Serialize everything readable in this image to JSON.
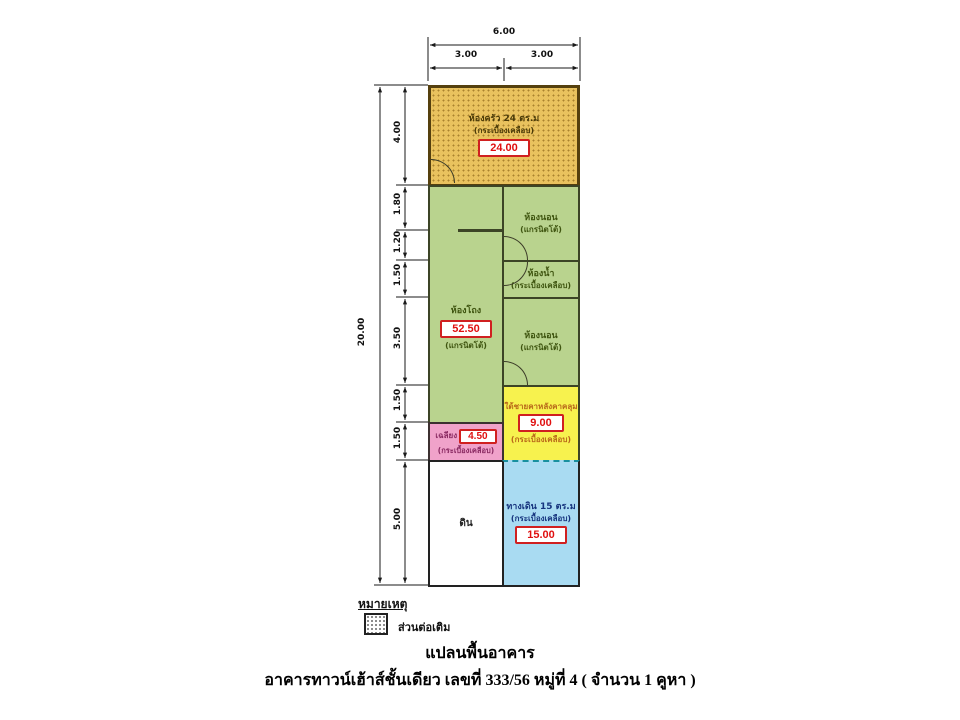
{
  "dims": {
    "top_total": "6.00",
    "top_segments": [
      "3.00",
      "3.00"
    ],
    "left_total": "20.00",
    "left_segments": [
      "4.00",
      "1.80",
      "1.20",
      "1.50",
      "3.50",
      "1.50",
      "1.50",
      "5.00"
    ]
  },
  "rooms": {
    "kitchen": {
      "name": "ห้องครัว 24 ตร.ม",
      "material": "(กระเบื้องเคลือบ)",
      "area": "24.00"
    },
    "hall": {
      "name": "ห้องโถง",
      "area": "52.50",
      "material": "(แกรนิตโต้)"
    },
    "bedroom_top": {
      "name": "ห้องนอน",
      "material": "(แกรนิตโต้)"
    },
    "bathroom": {
      "name": "ห้องน้ำ",
      "material": "(กระเบื้องเคลือบ)"
    },
    "bedroom_bottom": {
      "name": "ห้องนอน",
      "material": "(แกรนิตโต้)"
    },
    "covered_area": {
      "name": "ใต้ชายคาหลังคาคลุม",
      "area": "9.00",
      "material": "(กระเบื้องเคลือบ)"
    },
    "porch": {
      "name": "เฉลียง",
      "area": "4.50",
      "material": "(กระเบื้องเคลือบ)"
    },
    "soil": {
      "name": "ดิน"
    },
    "walkway": {
      "name": "ทางเดิน 15 ตร.ม",
      "material": "(กระเบื้องเคลือบ)",
      "area": "15.00"
    }
  },
  "legend": {
    "title": "หมายเหตุ",
    "extension_label": "ส่วนต่อเติม"
  },
  "captions": {
    "title": "แปลนพื้นอาคาร",
    "subtitle": "อาคารทาวน์เฮ้าส์ชั้นเดียว เลขที่ 333/56 หมู่ที่ 4 ( จำนวน 1 คูหา )"
  },
  "colors": {
    "kitchen_fill": "#e9c25e",
    "room_green": "#b9d38e",
    "covered_yellow": "#f7f24e",
    "porch_pink": "#f0a2ca",
    "walkway_blue": "#a9dbf2",
    "area_box_red": "#d02020",
    "dashed_teal": "#1890a0"
  }
}
